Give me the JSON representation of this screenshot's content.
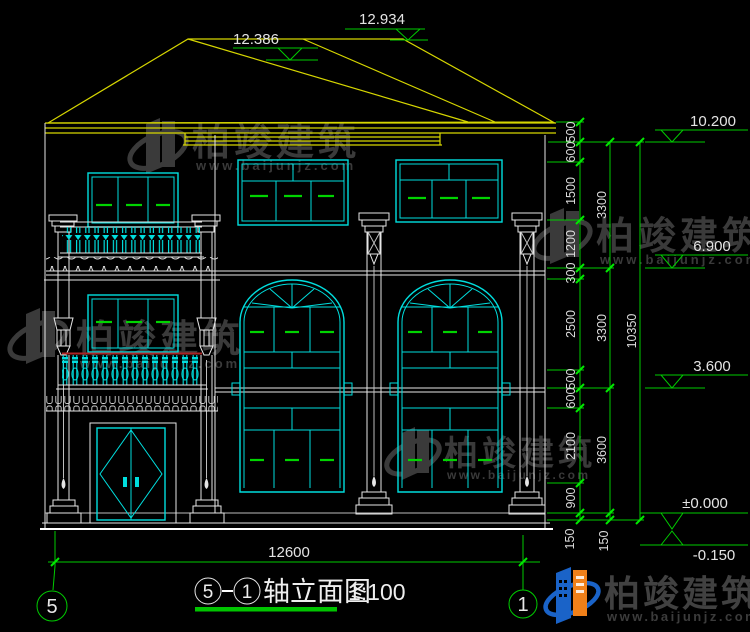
{
  "meta": {
    "background": "#000000"
  },
  "palette": {
    "line_white": "#e6e6e6",
    "cad_cyan": "#00dede",
    "cad_green": "#00cc00",
    "cad_yellow": "#d6d600",
    "cad_red": "#aa2424",
    "watermark_gray": "#3a3a3a",
    "logo_blue": "#1a63c8",
    "logo_orange": "#f08019"
  },
  "levels": {
    "ridge_main": "12.934",
    "ridge_left": "12.386",
    "eave": "10.200",
    "floor3": "6.900",
    "floor2": "3.600",
    "ground": "±0.000",
    "site": "-0.150"
  },
  "dims": {
    "col1": [
      "500",
      "600",
      "1500",
      "1200",
      "300",
      "2500",
      "500",
      "600",
      "2100",
      "900",
      "150"
    ],
    "col2": [
      "3300",
      "3300",
      "3600",
      "150"
    ],
    "col3": [
      "10350"
    ],
    "bottom": "12600"
  },
  "axes": {
    "left": "5",
    "right": "1"
  },
  "title": {
    "from": "5",
    "to": "1",
    "name": "轴立面图",
    "scale": "1:100"
  },
  "watermark": {
    "brand": "柏竣建筑",
    "site": "www.baijunjz.com"
  }
}
